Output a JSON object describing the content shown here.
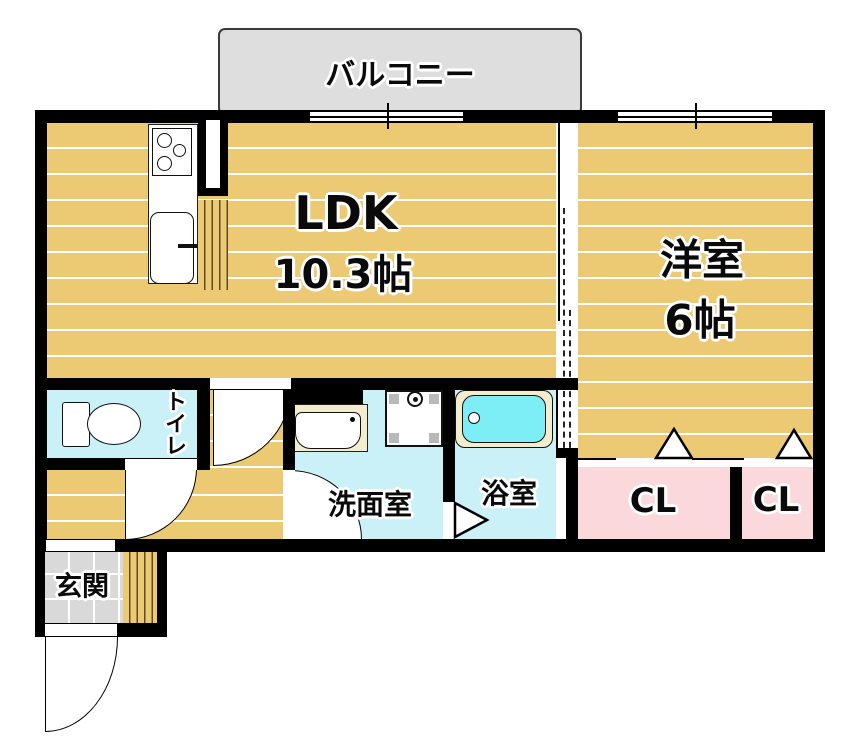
{
  "plan": {
    "balcony": {
      "label": "バルコニー"
    },
    "ldk": {
      "name": "LDK",
      "size": "10.3帖"
    },
    "western_room": {
      "name": "洋室",
      "size": "6帖"
    },
    "toilet": {
      "label": "トイレ"
    },
    "washroom": {
      "label": "洗面室"
    },
    "bathroom": {
      "label": "浴室"
    },
    "closet_left": {
      "label": "CL"
    },
    "closet_right": {
      "label": "CL"
    },
    "entrance": {
      "label": "玄関"
    }
  },
  "colors": {
    "wall": "#000000",
    "floor_tan": "#ecc973",
    "wet_cyan": "#c9f1f7",
    "tub_cyan": "#7deef5",
    "tub_surround": "#f3edcf",
    "closet_pink": "#fbd8db",
    "balcony_gray": "#dedede",
    "entrance_tile": "#d9d9d9"
  }
}
